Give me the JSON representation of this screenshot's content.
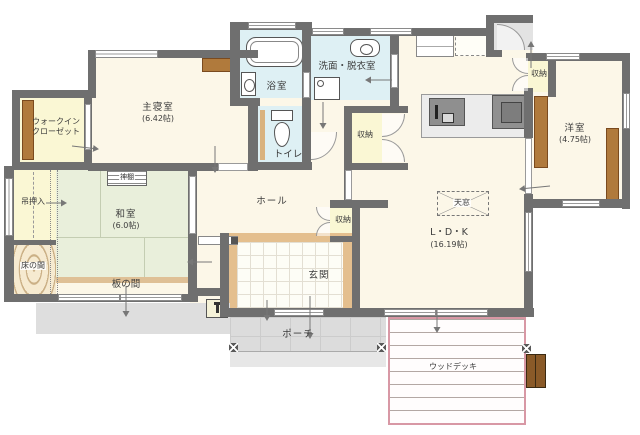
{
  "canvas": {
    "width": 640,
    "height": 435
  },
  "colors": {
    "wall": "#6f6f6f",
    "floor_cream": "#fcf7e8",
    "tatami_green": "#e9efdb",
    "wet_area_blue": "#def0f4",
    "closet_yellow": "#faf7d4",
    "closet_brown": "#b07a3c",
    "entrance_tan": "#e4bf8e",
    "porch_gray": "#dcdcdc",
    "deck_edge_pink": "#d898a5"
  },
  "rooms": {
    "master_bedroom": {
      "name": "主寝室",
      "size": "(6.42帖)"
    },
    "walk_in_closet": {
      "line1": "ウォークイン",
      "line2": "クローゼット"
    },
    "bathroom": {
      "name": "浴室"
    },
    "washroom": {
      "name": "洗面・脱衣室"
    },
    "toilet": {
      "name": "トイレ"
    },
    "storage_by_washroom": {
      "name": "収納"
    },
    "storage_north": {
      "name": "収納"
    },
    "storage_entrance": {
      "name": "収納"
    },
    "western_room": {
      "name": "洋室",
      "size": "(4.75帖)"
    },
    "hanging_closet": {
      "name": "吊押入"
    },
    "kamidana": {
      "name": "神棚"
    },
    "japanese_room": {
      "name": "和室",
      "size": "(6.0帖)"
    },
    "tokonoma": {
      "name": "床の間"
    },
    "itanoma": {
      "name": "板の間"
    },
    "hall": {
      "name": "ホール"
    },
    "entrance": {
      "name": "玄関"
    },
    "skylight": {
      "name": "天窓"
    },
    "ldk": {
      "name": "L・D・K",
      "size": "(16.19帖)"
    },
    "porch": {
      "name": "ポーチ"
    },
    "wood_deck": {
      "name": "ウッドデッキ"
    }
  }
}
